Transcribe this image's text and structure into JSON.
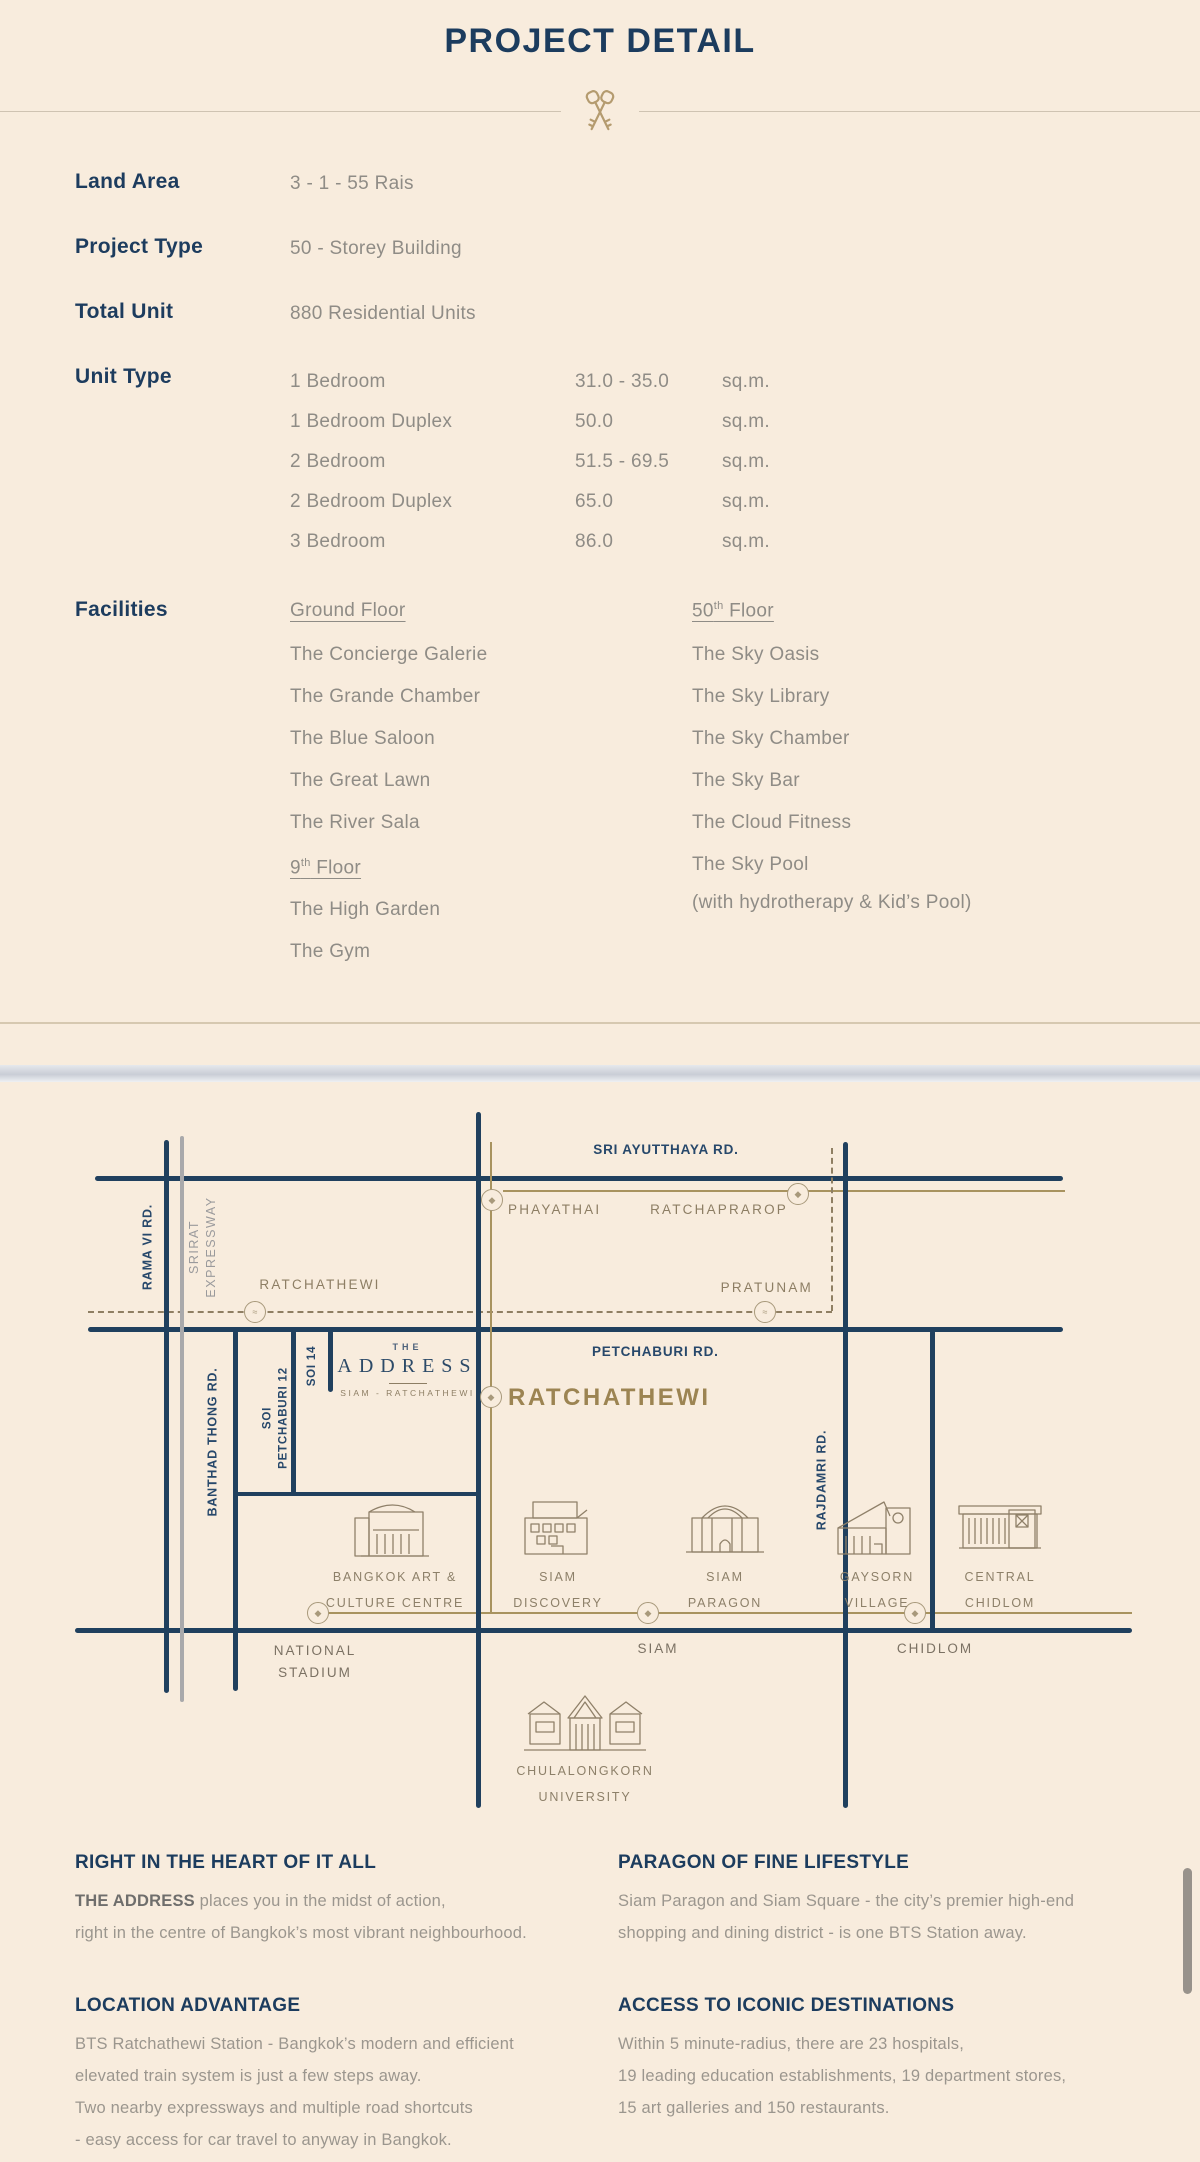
{
  "colors": {
    "navy": "#1d3c5e",
    "gold": "#b49b6f",
    "map_tan": "#8d7e64",
    "road_navy": "#20405e",
    "background": "#f8ecdd"
  },
  "header": {
    "title": "PROJECT DETAIL"
  },
  "details": {
    "land_area": {
      "label": "Land Area",
      "value": "3 - 1 - 55 Rais"
    },
    "project_type": {
      "label": "Project Type",
      "value": "50 - Storey Building"
    },
    "total_unit": {
      "label": "Total Unit",
      "value": "880 Residential Units"
    },
    "unit_type": {
      "label": "Unit Type",
      "rows": [
        {
          "name": "1 Bedroom",
          "size": "31.0 - 35.0",
          "unit": "sq.m."
        },
        {
          "name": "1 Bedroom Duplex",
          "size": "50.0",
          "unit": "sq.m."
        },
        {
          "name": "2 Bedroom",
          "size": "51.5 - 69.5",
          "unit": "sq.m."
        },
        {
          "name": "2 Bedroom Duplex",
          "size": "65.0",
          "unit": "sq.m."
        },
        {
          "name": "3 Bedroom",
          "size": "86.0",
          "unit": "sq.m."
        }
      ]
    },
    "facilities": {
      "label": "Facilities",
      "ground": {
        "title": "Ground Floor",
        "items": [
          "The Concierge Galerie",
          "The Grande Chamber",
          "The Blue Saloon",
          "The Great Lawn",
          "The River Sala"
        ]
      },
      "floor9": {
        "pre": "9",
        "sup": "th",
        "post": " Floor",
        "items": [
          "The High Garden",
          "The Gym"
        ]
      },
      "floor50": {
        "pre": "50",
        "sup": "th",
        "post": " Floor",
        "items": [
          "The Sky Oasis",
          "The Sky Library",
          "The Sky Chamber",
          "The Sky Bar",
          "The Cloud Fitness",
          "The Sky Pool"
        ],
        "note": "(with hydrotherapy & Kid’s Pool)"
      }
    }
  },
  "map": {
    "icons": {
      "bts": "◆",
      "pier": "≈"
    },
    "roads": {
      "sri_ayutthaya": "SRI AYUTTHAYA RD.",
      "petchaburi": "PETCHABURI RD.",
      "rama6": "RAMA VI RD.",
      "srirat_1": "SRIRAT",
      "srirat_2": "EXPRESSWAY",
      "banthad": "BANTHAD THONG RD.",
      "soi12_1": "SOI",
      "soi12_2": "PETCHABURI 12",
      "soi14": "SOI 14",
      "rajdamri": "RAJDAMRI RD."
    },
    "stations": {
      "phayathai": "PHAYATHAI",
      "ratchaprarop": "RATCHAPRAROP",
      "pratunam": "PRATUNAM",
      "ratchathewi_small": "RATCHATHEWI",
      "ratchathewi_big": "RATCHATHEWI",
      "national_stadium_1": "NATIONAL",
      "national_stadium_2": "STADIUM",
      "siam": "SIAM",
      "chidlom": "CHIDLOM"
    },
    "places": {
      "bacc_1": "BANGKOK ART &",
      "bacc_2": "CULTURE CENTRE",
      "discovery_1": "SIAM",
      "discovery_2": "DISCOVERY",
      "paragon_1": "SIAM",
      "paragon_2": "PARAGON",
      "gaysorn_1": "GAYSORN",
      "gaysorn_2": "VILLAGE",
      "central_1": "CENTRAL",
      "central_2": "CHIDLOM",
      "chula_1": "CHULALONGKORN",
      "chula_2": "UNIVERSITY"
    },
    "project": {
      "the": "THE",
      "name": "ADDRESS",
      "sub": "SIAM - RATCHATHEWI"
    }
  },
  "sections": {
    "heart": {
      "title": "RIGHT IN THE HEART OF IT ALL",
      "bold": "THE ADDRESS",
      "line1": " places you in the midst of action,",
      "line2": "right in the centre of Bangkok’s most vibrant neighbourhood."
    },
    "location": {
      "title": "LOCATION ADVANTAGE",
      "line1": "BTS Ratchathewi Station - Bangkok’s modern and efficient",
      "line2": "elevated train system is just a few steps away.",
      "line3": "Two nearby expressways and multiple road shortcuts",
      "line4": "- easy access for car travel to anyway in Bangkok."
    },
    "paragon": {
      "title": "PARAGON OF FINE LIFESTYLE",
      "line1": "Siam Paragon and Siam Square - the city’s premier high-end",
      "line2": "shopping and dining district - is one BTS Station away."
    },
    "access": {
      "title": "ACCESS TO ICONIC DESTINATIONS",
      "line1": "Within 5 minute-radius, there are 23 hospitals,",
      "line2": "19 leading education establishments, 19 department stores,",
      "line3": "15 art galleries and 150 restaurants."
    }
  }
}
